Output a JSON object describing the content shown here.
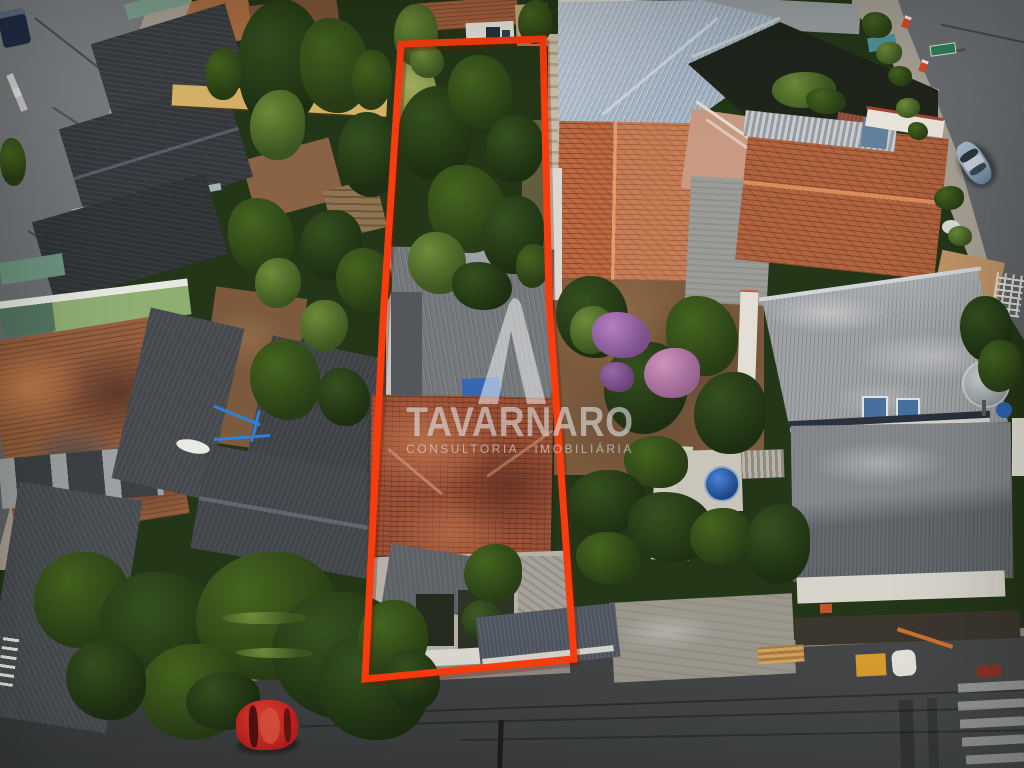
{
  "meta": {
    "kind": "aerial-drone-real-estate-photo",
    "width_px": 1024,
    "height_px": 768,
    "subject": "overgrown deep residential lot outlined in red-orange among houses, streets on left, bottom and right"
  },
  "watermark": {
    "brand": "TAVARNARO",
    "tagline": "CONSULTORIA IMOBILIÁRIA",
    "logo": "rounded-peak-A-monogram",
    "color": "rgba(250,250,250,0.55)",
    "opacity": 0.95
  },
  "property_outline": {
    "color": "#f93c0e",
    "shadow_color": "rgba(120,25,0,0.33)",
    "stroke_px": 7,
    "points": [
      [
        401,
        44
      ],
      [
        543,
        39
      ],
      [
        549,
        300
      ],
      [
        574,
        659
      ],
      [
        365,
        679
      ],
      [
        383,
        320
      ]
    ]
  },
  "palette": {
    "vegetation": "#243618",
    "asphalt": "#77797d",
    "asphalt-dark": "#3f4143",
    "asphalt-right": "#66696d",
    "sidewalk": "#a39c90",
    "curb-paint": "#a89d52",
    "roof-dark": "#383c40",
    "roof-darker": "#2f3336",
    "roof-mid": "#45494d",
    "roof-gray": "#9fa2a5",
    "roof-gray-dark": "#64686d",
    "metal-blue": "#a3b2c2",
    "shade-mesh": "#20251c",
    "terracotta-old": "#96603f",
    "terracotta-bright": "#bb6a43",
    "terracotta-right": "#b06440",
    "terracotta-property": "#9b5136",
    "slate": "#4e5560",
    "dirt": "#7d5a3d",
    "sand": "#c6a97e",
    "yellow-wall": "#d7b368",
    "white-wall": "#e9e6df",
    "car-red": "#c41f1f",
    "car-silver-blue": "#8fa3b8",
    "tank-blue": "#2d62b4",
    "swing-blue": "#2f80d8",
    "flower-purple": "#b57fc2",
    "flower-pink": "#d093bd",
    "crosswalk-white": "rgba(235,235,232,0.5)",
    "sign-green": "#2f7d55",
    "bollard-red": "#d64a26",
    "watermark-ink": "rgba(250,250,250,0.55)"
  },
  "veg_tones": {
    "d": [
      "#35511f",
      "#1d2f12"
    ],
    "m": [
      "#45651f",
      "#283d15"
    ],
    "l": [
      "#6d8c3a",
      "#3b5520"
    ],
    "p1": [
      "#b57fc2",
      "#7a4f8a"
    ],
    "p2": [
      "#d093bd",
      "#95628f"
    ],
    "p3": [
      "#9a68a8",
      "#6a4378"
    ]
  },
  "vegetation_blobs": [
    [
      238,
      0,
      85,
      130,
      "d"
    ],
    [
      300,
      18,
      70,
      95,
      "m"
    ],
    [
      250,
      90,
      55,
      70,
      "l"
    ],
    [
      338,
      112,
      60,
      85,
      "d"
    ],
    [
      352,
      50,
      40,
      60,
      "m"
    ],
    [
      228,
      198,
      66,
      76,
      "m"
    ],
    [
      300,
      210,
      62,
      70,
      "d"
    ],
    [
      336,
      248,
      56,
      64,
      "m"
    ],
    [
      255,
      258,
      46,
      50,
      "l"
    ],
    [
      0,
      138,
      26,
      48,
      "m"
    ],
    [
      205,
      48,
      36,
      52,
      "m"
    ],
    [
      250,
      340,
      70,
      80,
      "m"
    ],
    [
      300,
      300,
      48,
      52,
      "l"
    ],
    [
      318,
      368,
      52,
      58,
      "d"
    ],
    [
      398,
      86,
      74,
      95,
      "d"
    ],
    [
      448,
      55,
      64,
      74,
      "m"
    ],
    [
      486,
      115,
      58,
      68,
      "d"
    ],
    [
      428,
      165,
      78,
      88,
      "m"
    ],
    [
      482,
      196,
      62,
      78,
      "d"
    ],
    [
      408,
      232,
      58,
      62,
      "l"
    ],
    [
      516,
      244,
      34,
      44,
      "m"
    ],
    [
      452,
      262,
      60,
      48,
      "d"
    ],
    [
      464,
      544,
      58,
      58,
      "m"
    ],
    [
      556,
      276,
      72,
      82,
      "d"
    ],
    [
      604,
      342,
      84,
      92,
      "d"
    ],
    [
      666,
      296,
      72,
      80,
      "m"
    ],
    [
      694,
      372,
      72,
      82,
      "d"
    ],
    [
      624,
      436,
      64,
      52,
      "m"
    ],
    [
      570,
      306,
      44,
      48,
      "l"
    ],
    [
      592,
      312,
      58,
      46,
      "p1"
    ],
    [
      644,
      348,
      56,
      50,
      "p2"
    ],
    [
      600,
      362,
      34,
      30,
      "p3"
    ],
    [
      568,
      470,
      78,
      64,
      "d"
    ],
    [
      628,
      492,
      86,
      70,
      "d"
    ],
    [
      690,
      508,
      60,
      56,
      "m"
    ],
    [
      576,
      532,
      64,
      52,
      "m"
    ],
    [
      772,
      72,
      64,
      36,
      "l"
    ],
    [
      806,
      88,
      40,
      26,
      "m"
    ],
    [
      746,
      504,
      64,
      80,
      "d"
    ],
    [
      960,
      296,
      52,
      66,
      "d"
    ],
    [
      978,
      340,
      44,
      52,
      "m"
    ],
    [
      862,
      12,
      30,
      26,
      "m"
    ],
    [
      876,
      42,
      26,
      22,
      "l"
    ],
    [
      888,
      66,
      24,
      20,
      "m"
    ],
    [
      896,
      98,
      24,
      20,
      "l"
    ],
    [
      908,
      122,
      20,
      18,
      "m"
    ],
    [
      934,
      186,
      30,
      24,
      "m"
    ],
    [
      948,
      226,
      24,
      20,
      "l"
    ],
    [
      34,
      552,
      96,
      96,
      "m"
    ],
    [
      100,
      572,
      130,
      120,
      "d"
    ],
    [
      196,
      552,
      140,
      128,
      "m"
    ],
    [
      272,
      592,
      140,
      128,
      "d"
    ],
    [
      140,
      644,
      110,
      96,
      "m"
    ],
    [
      318,
      636,
      110,
      104,
      "d"
    ],
    [
      186,
      672,
      74,
      58,
      "d"
    ],
    [
      66,
      640,
      80,
      80,
      "d"
    ],
    [
      358,
      600,
      70,
      80,
      "m"
    ],
    [
      386,
      650,
      54,
      60,
      "d"
    ],
    [
      222,
      612,
      84,
      12,
      "l"
    ],
    [
      236,
      648,
      76,
      10,
      "l"
    ],
    [
      394,
      4,
      44,
      62,
      "l"
    ],
    [
      410,
      44,
      34,
      34,
      "l"
    ],
    [
      518,
      0,
      34,
      44,
      "m"
    ]
  ],
  "scene_objects": [
    "left-street",
    "bottom-street",
    "right-street",
    "crosswalk-bottom-right",
    "crosswalk-dashes-top-left",
    "red-parked-car",
    "silver-blue-parked-car",
    "property-lot-outline",
    "overgrown-lot-trees",
    "property-gray-roof-house",
    "property-terracotta-roof-house",
    "property-rear-patio",
    "neighbor-dark-roofs",
    "old-terracotta-roof",
    "center-terracotta-house",
    "right-terracotta-house",
    "metal-warehouse-roof",
    "shade-mesh-canopy",
    "garden-with-bougainvillea",
    "water-tank",
    "satellite-dish",
    "utility-wires",
    "street-name-sign",
    "curb-bollards",
    "lumber-stack",
    "tree-canopy",
    "swing-frame",
    "canoe",
    "yellow-boundary-wall",
    "white-walls",
    "dirt-yards"
  ]
}
